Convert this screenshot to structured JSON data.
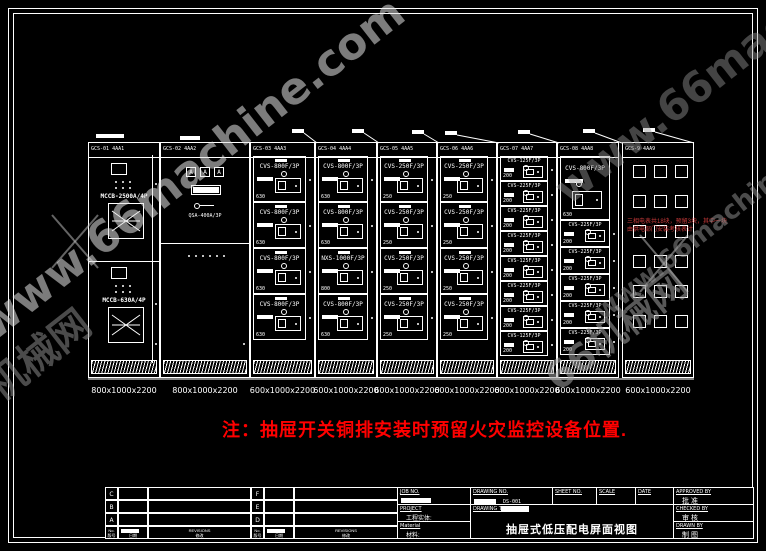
{
  "watermark": {
    "site_en": "www.66machine.com",
    "site_cn": "66机械网"
  },
  "note": {
    "text": "注：抽屉开关铜排安装时预留火灾监控设备位置."
  },
  "annotation": {
    "line1": "三相电表共18块，预留3块，其中一块",
    "line2": "由供电部门安装考核表计"
  },
  "colors": {
    "background": "#000000",
    "line": "#ffffff",
    "note_red": "#ff0000",
    "annotation_red": "#c93a3a",
    "watermark_gray": "#bdbdbd"
  },
  "cabinets": [
    {
      "name": "GCS-01 4AA1",
      "dim": "800x1000x2200",
      "type": "incomer",
      "sections": [
        {
          "breaker": "MCCB-2500A/4P"
        },
        {
          "breaker": "MCCB-630A/4P"
        }
      ]
    },
    {
      "name": "GCS-02 4AA2",
      "dim": "800x1000x2200",
      "type": "metering",
      "meters": [
        "A",
        "A",
        "A"
      ],
      "switch_label": "QSA-400A/3P"
    },
    {
      "name": "GCS-03 4AA3",
      "dim": "600x1000x2200",
      "type": "feeder",
      "rows": [
        {
          "label": "CVS-800F/3P",
          "rating": "630"
        },
        {
          "label": "CVS-800F/3P",
          "rating": "630"
        },
        {
          "label": "CVS-800F/3P",
          "rating": "630"
        },
        {
          "label": "CVS-800F/3P",
          "rating": "630"
        }
      ]
    },
    {
      "name": "GCS-04 4AA4",
      "dim": "600x1000x2200",
      "type": "feeder",
      "rows": [
        {
          "label": "CVS-800F/3P",
          "rating": "630"
        },
        {
          "label": "CVS-800F/3P",
          "rating": "630"
        },
        {
          "label": "NXS-1000F/3P",
          "rating": "800"
        },
        {
          "label": "CVS-800F/3P",
          "rating": "630"
        }
      ]
    },
    {
      "name": "GCS-05 4AA5",
      "dim": "600x1000x2200",
      "type": "feeder",
      "rows": [
        {
          "label": "CVS-250F/3P",
          "rating": "250"
        },
        {
          "label": "CVS-250F/3P",
          "rating": "250"
        },
        {
          "label": "CVS-250F/3P",
          "rating": "250"
        },
        {
          "label": "CVS-250F/3P",
          "rating": "250"
        }
      ]
    },
    {
      "name": "GCS-06 4AA6",
      "dim": "600x1000x2200",
      "type": "feeder",
      "rows": [
        {
          "label": "CVS-250F/3P",
          "rating": "250"
        },
        {
          "label": "CVS-250F/3P",
          "rating": "250"
        },
        {
          "label": "CVS-250F/3P",
          "rating": "250"
        },
        {
          "label": "CVS-250F/3P",
          "rating": "250"
        }
      ]
    },
    {
      "name": "GCS-07 4AA7",
      "dim": "600x1000x2200",
      "type": "feeder-compact",
      "rows": [
        {
          "label": "CVS-125F/3P",
          "rating": "200"
        },
        {
          "label": "CVS-225F/3P",
          "rating": "200"
        },
        {
          "label": "CVS-225F/3P",
          "rating": "200"
        },
        {
          "label": "CVS-225F/3P",
          "rating": "200"
        },
        {
          "label": "CVS-125F/3P",
          "rating": "200"
        },
        {
          "label": "CVS-225F/3P",
          "rating": "200"
        },
        {
          "label": "CVS-225F/3P",
          "rating": "200"
        },
        {
          "label": "CVS-125F/3P",
          "rating": "200"
        }
      ]
    },
    {
      "name": "GCS-08 4AA8",
      "dim": "600x1000x2200",
      "type": "feeder-mixed",
      "big": {
        "label": "CVS-800F/3P",
        "rating": "630"
      },
      "rows": [
        {
          "label": "CVS-225F/3P",
          "rating": "200"
        },
        {
          "label": "CVS-225F/3P",
          "rating": "200"
        },
        {
          "label": "CVS-225F/3P",
          "rating": "200"
        },
        {
          "label": "CVS-225F/3P",
          "rating": "200"
        },
        {
          "label": "CVS-225F/3P",
          "rating": "200"
        }
      ]
    },
    {
      "name": "GCS-9 4AA9",
      "dim": "600x1000x2200",
      "type": "spare",
      "grid": {
        "cols": 3,
        "rows": 6
      }
    }
  ],
  "title_block": {
    "revisions": {
      "left_letters": [
        "C",
        "B",
        "A"
      ],
      "right_letters": [
        "F",
        "E",
        "D"
      ],
      "no_en": "No.",
      "no_cn": "版号",
      "date_en": "DATE",
      "date_cn": "日期",
      "rev_en": "REVISIONS",
      "rev_cn": "修改"
    },
    "job_no_label": "JOB NO.",
    "drawing_no_label": "DRAWING NO.",
    "drawing_no_value": "DS-001",
    "sheet_no_label": "SHEET NO.",
    "scale_label": "SCALE",
    "date_label": "DATE",
    "approved_label": "APPROVED BY",
    "approved_cn": "批  准",
    "project_label": "PROJECT",
    "project_cn": "工程实体:",
    "drawing_title_label": "DRAWING TITLE",
    "drawing_title_value": "抽屉式低压配电屏面视图",
    "checked_label": "CHECKED BY",
    "checked_cn": "审  核",
    "material_label": "Material",
    "material_cn": "材料:",
    "drawn_label": "DRAWN BY",
    "drawn_cn": "制  图"
  }
}
